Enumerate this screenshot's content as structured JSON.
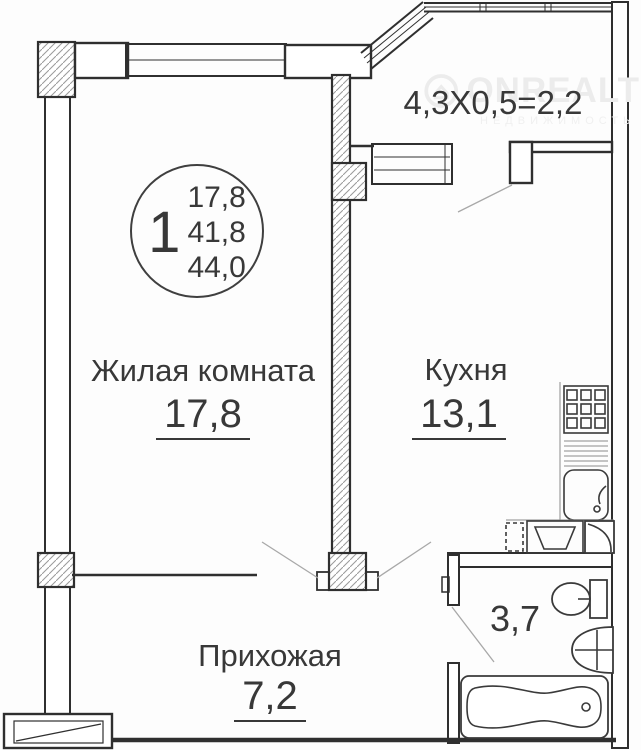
{
  "watermark": {
    "brand": "ONREALT",
    "subtitle": "НЕДВИЖИМОСТЬ"
  },
  "unit_stamp": {
    "room_count": "1",
    "living_area": "17,8",
    "area_without_balcony": "41,8",
    "total_area": "44,0"
  },
  "rooms": {
    "living_room": {
      "name": "Жилая комната",
      "area": "17,8"
    },
    "kitchen": {
      "name": "Кухня",
      "area": "13,1"
    },
    "hallway": {
      "name": "Прихожая",
      "area": "7,2"
    },
    "bathroom": {
      "area": "3,7"
    },
    "balcony": {
      "dimension": "4,3Х0,5=2,2"
    }
  },
  "fixtures": [
    "stove",
    "kitchen-sink",
    "washing-machine",
    "toilet",
    "washbasin",
    "bathtub",
    "entrance-door"
  ],
  "colors": {
    "wall_line": "#2f2f2f",
    "text": "#383838",
    "hatch": "#9a9a9a",
    "door_swing": "#a8a8a8",
    "background": "#ffffff",
    "watermark": "#ececec"
  }
}
